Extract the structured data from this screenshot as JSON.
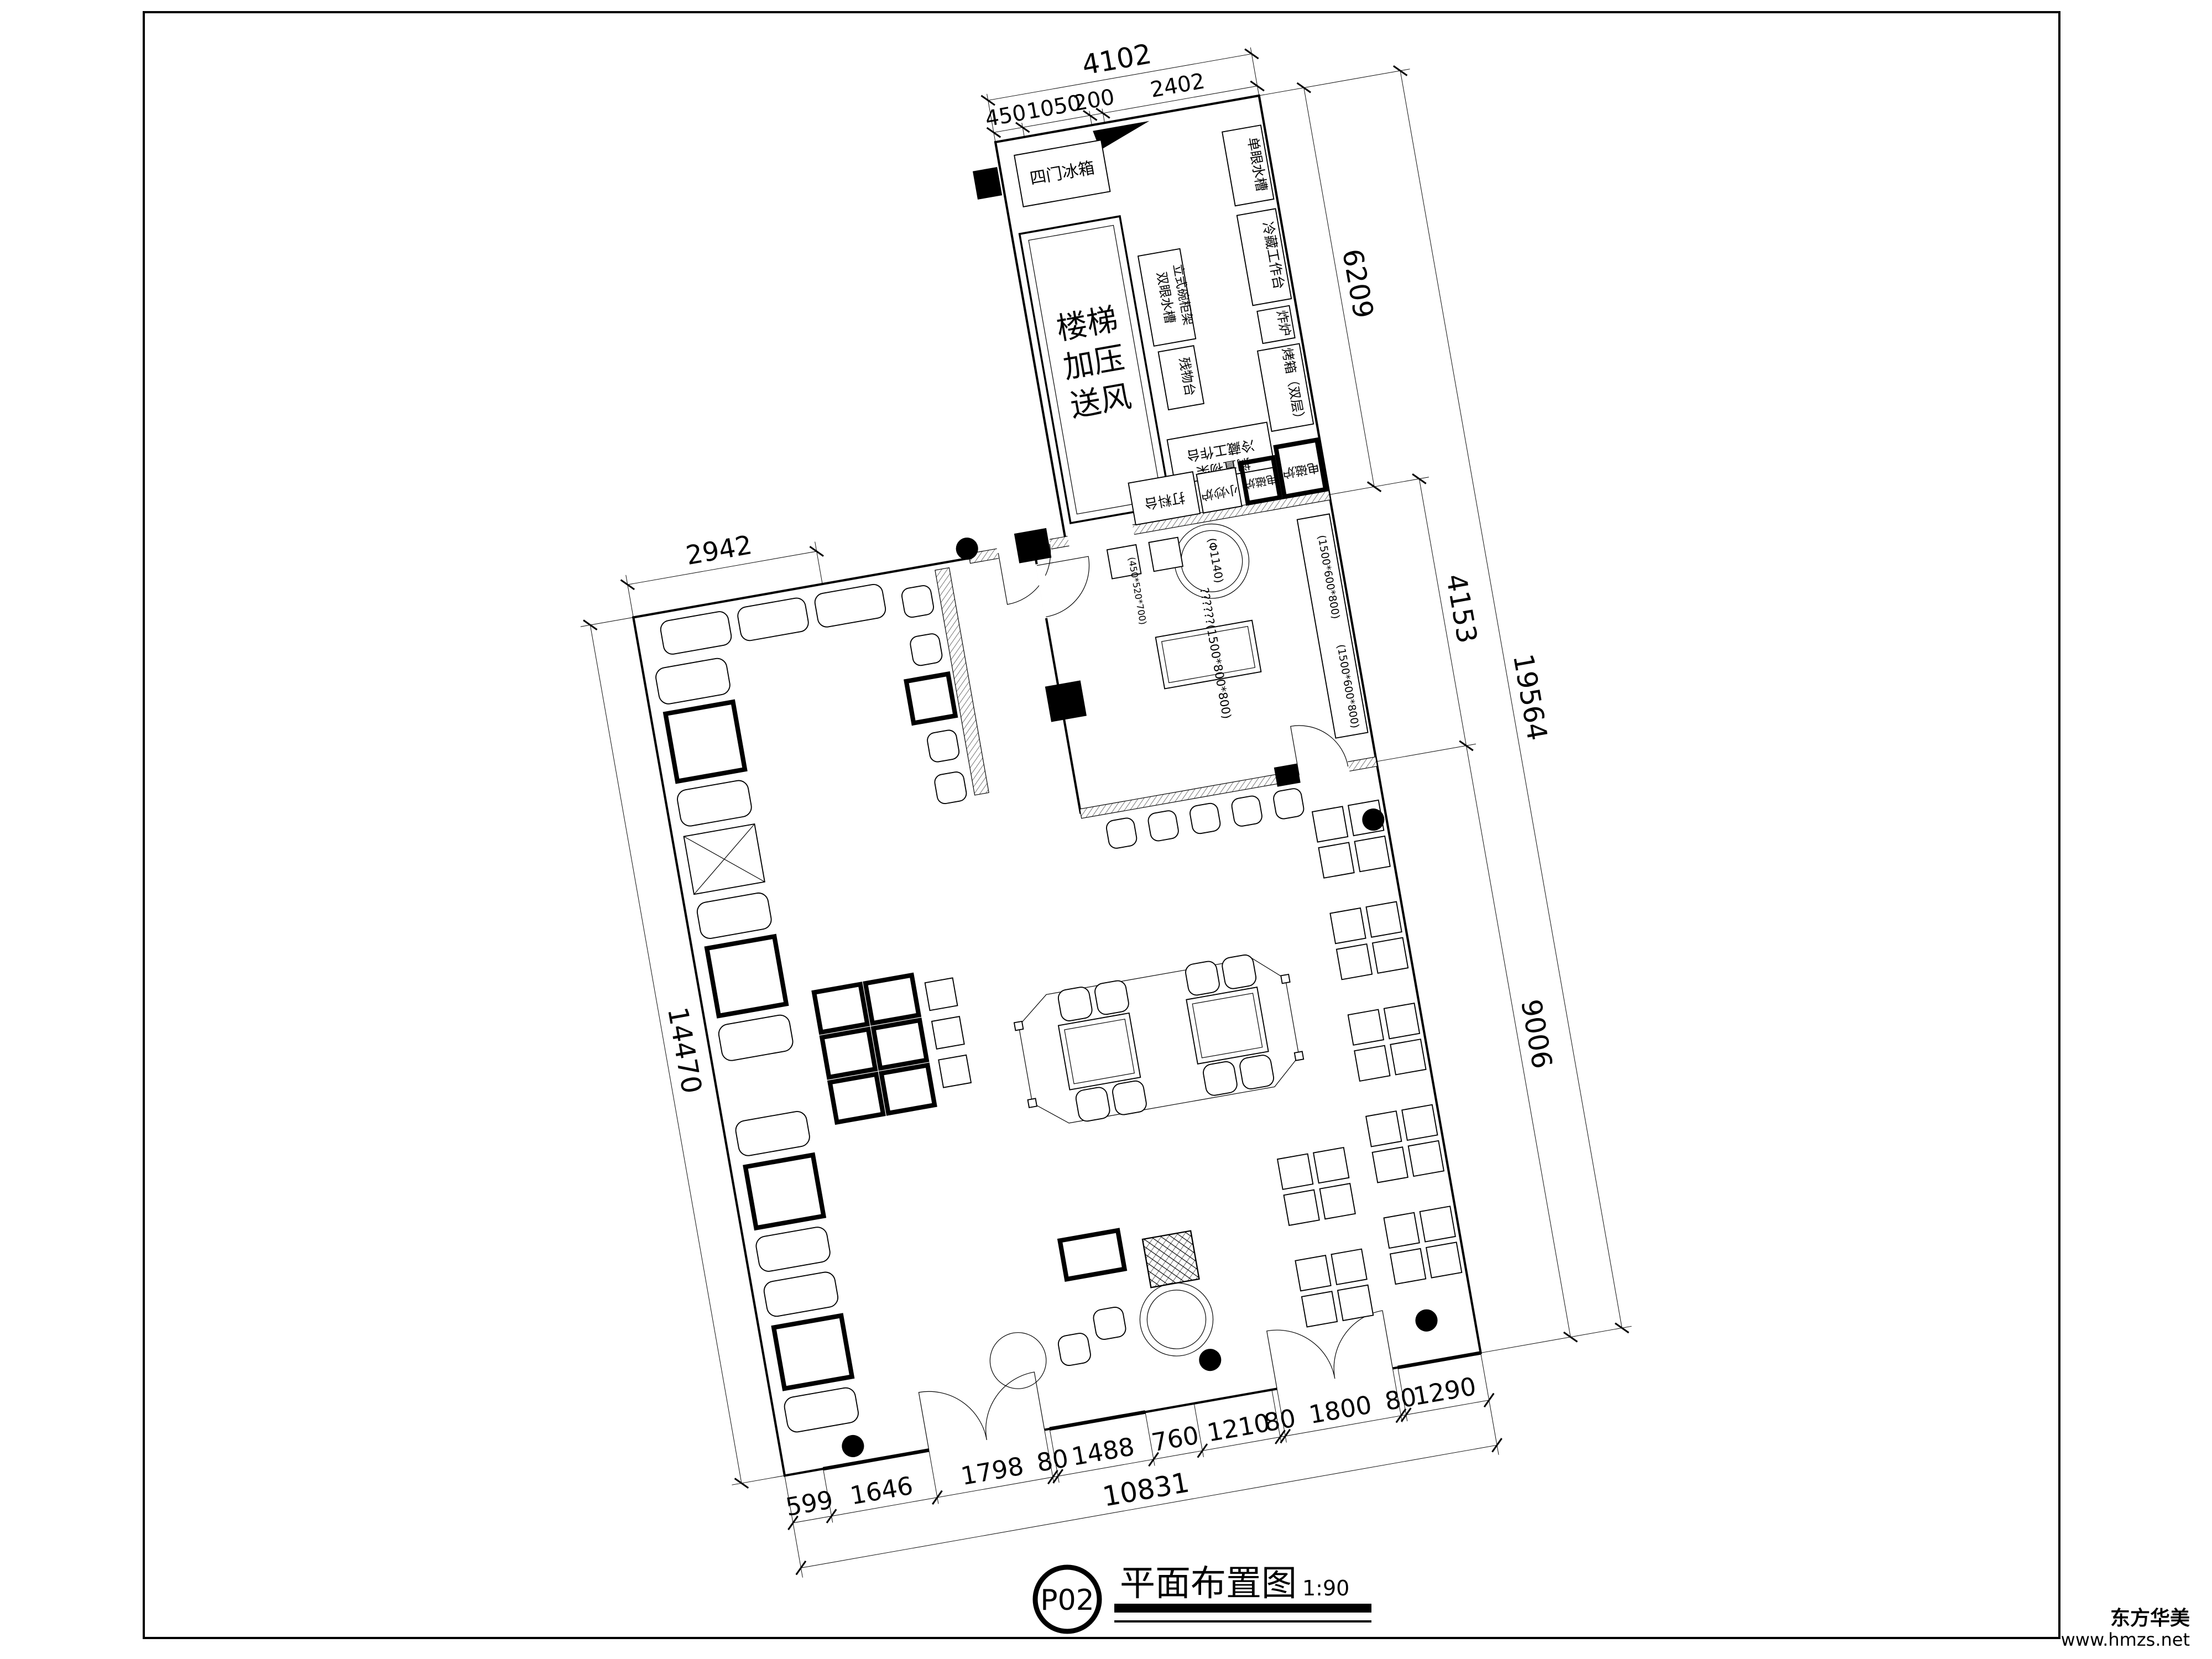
{
  "title_block": {
    "code": "P02",
    "title": "平面布置图",
    "scale": "1:90"
  },
  "watermark": {
    "line1": "东方华美",
    "line2": "www.hmzs.net"
  },
  "stair_shaft": {
    "line1": "楼梯",
    "line2": "加压",
    "line3": "送风"
  },
  "kitchen": {
    "fridge": "四门冰箱",
    "sink_single": "单眼水槽",
    "sink_double": "双眼水槽",
    "rack": "立式碗柜架",
    "waste_table": "残物台",
    "cold_table_right": "冷藏工作台",
    "fryer": "炸炉",
    "oven": "烤箱（双层）",
    "cold_table_bottom": "冷藏工作台",
    "shelf_bottom": "搁置物架",
    "prep_table": "打料台",
    "stirfry_stove": "小炒炉",
    "induction1": "电磁炉",
    "induction2": "电磁炉"
  },
  "specs": {
    "center_table": "??????(1500*800*800)",
    "round_table": "(Φ1140)",
    "side_counter": "(1500*600*800)",
    "side_counter2": "(1500*600*800)",
    "small_table": "(450*520*700)"
  },
  "dims": {
    "top_total": "4102",
    "top_segments": [
      "450",
      "1050",
      "200",
      "2402"
    ],
    "right_kitchen": "6209",
    "right_mid": "4153",
    "right_total": "19564",
    "right_lower": "9006",
    "left_top": "2942",
    "left_side": "14470",
    "bottom_segments": [
      "599",
      "1646",
      "1798",
      "80",
      "1488",
      "760",
      "1210",
      "80",
      "1800",
      "80",
      "1290"
    ],
    "bottom_total": "10831"
  }
}
